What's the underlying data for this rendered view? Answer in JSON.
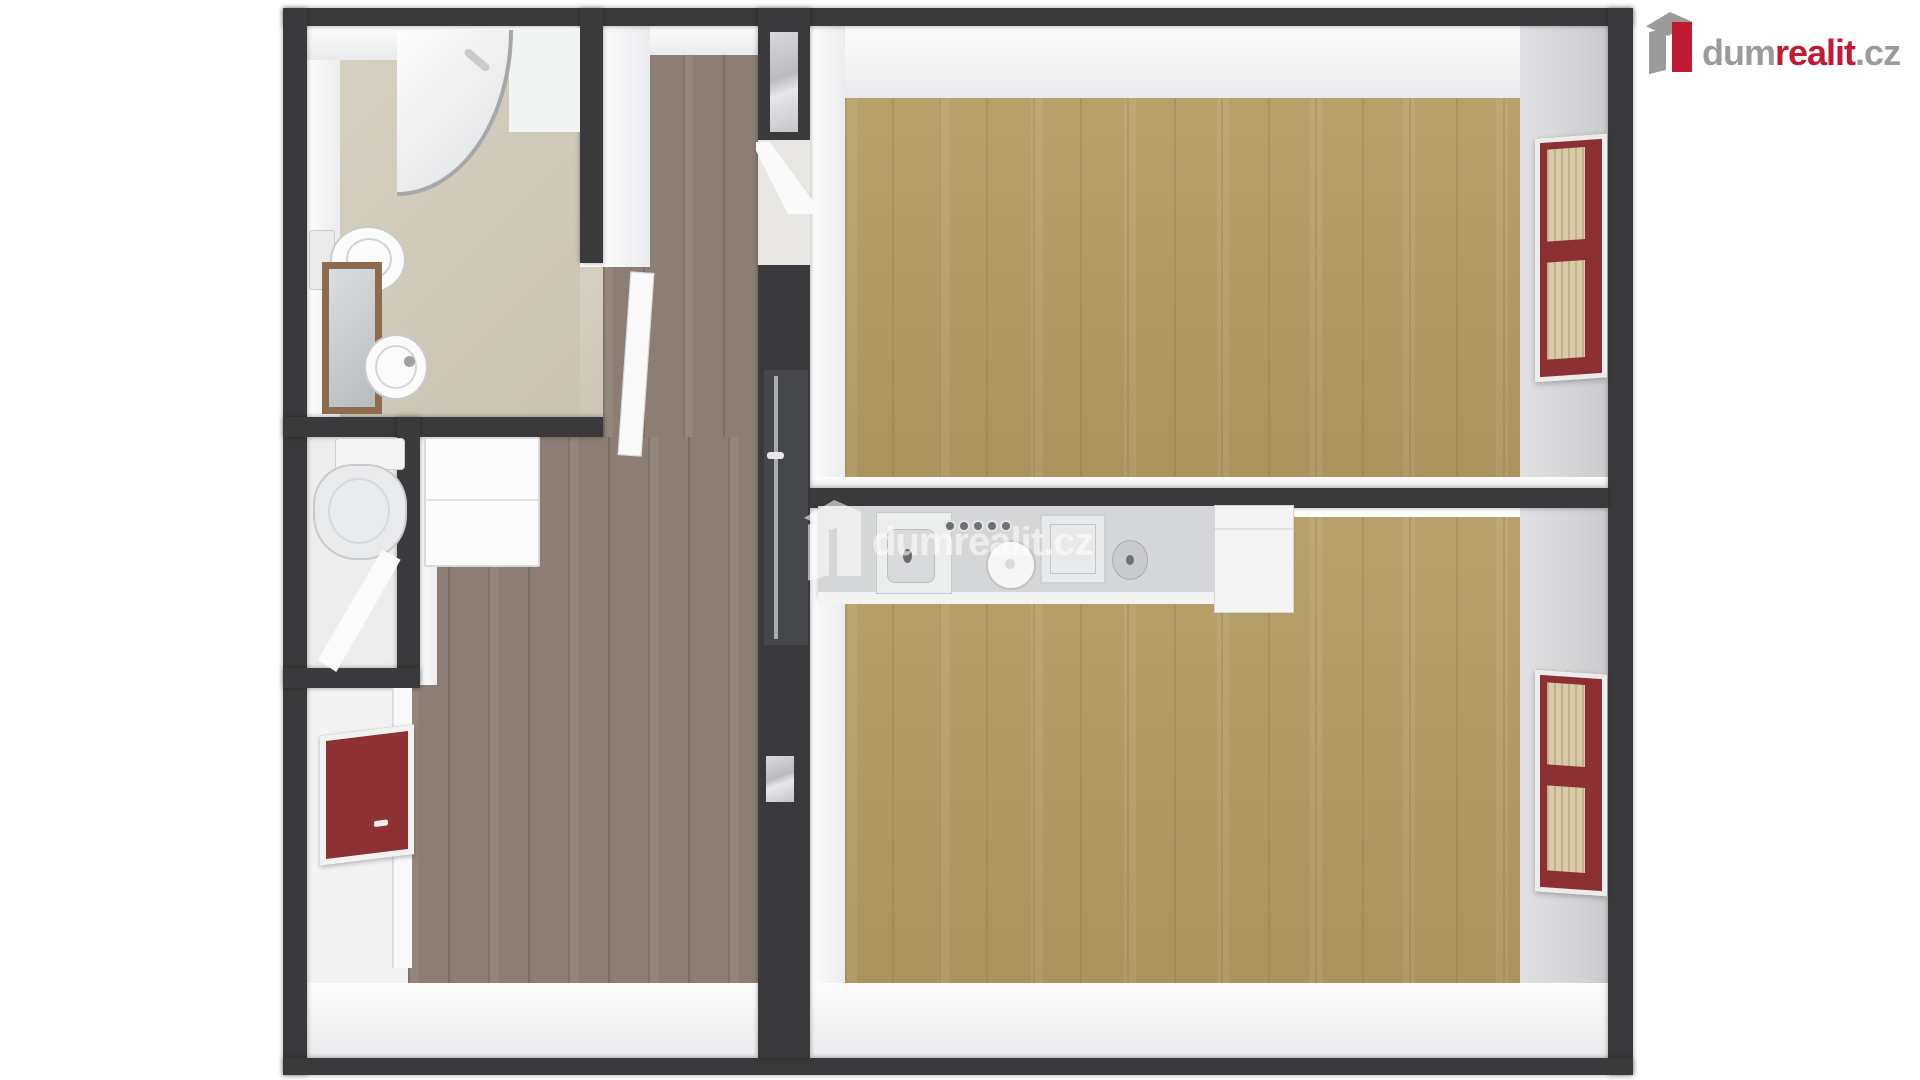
{
  "branding": {
    "logo": {
      "dum": "dum",
      "realit": "realit",
      "cz": ".cz",
      "icon": "dumrealit-building-icon"
    }
  },
  "watermark": {
    "text": "dumrealit.cz",
    "icon": "dumrealit-building-icon",
    "opacity": 0.58
  },
  "colors": {
    "wall": "#3a3a3c",
    "floorTan": "#b59b62",
    "floorTaupe": "#8c7e74",
    "floorBeige": "#cfc8b8",
    "windowRed": "#8c3034",
    "windowFill": "#d8cba6",
    "radiatorRed": "#8e3134",
    "counter": "#d5d6d8",
    "logoRed": "#c01b32",
    "logoGray": "#9b9b9b"
  },
  "floorplan": {
    "type": "3d-top-down-apartment-floor-plan",
    "rooms": [
      {
        "name": "bathroom",
        "position": "top-left",
        "floor": "beige tile",
        "fixtures": [
          "corner-shower",
          "wall-hung-toilet",
          "washbasin",
          "wood-framed-mirror"
        ]
      },
      {
        "name": "wc",
        "position": "middle-left",
        "floor": "white tile",
        "fixtures": [
          "toilet-with-cistern",
          "open-door"
        ]
      },
      {
        "name": "entry-room",
        "position": "bottom-left",
        "floor": "white",
        "fixtures": [
          "red-framed-window"
        ]
      },
      {
        "name": "hallway",
        "position": "center",
        "floor": "dark taupe wood planks",
        "fixtures": [
          "tall-white-cabinet",
          "open-bathroom-door",
          "glazed-interior-door"
        ]
      },
      {
        "name": "living-room",
        "position": "top-right",
        "floor": "light oak wood planks",
        "fixtures": [
          "red-framed-window-right-wall"
        ]
      },
      {
        "name": "kitchen-bedroom",
        "position": "bottom-right",
        "floor": "light oak wood planks",
        "fixtures": [
          "kitchen-counter",
          "sink",
          "stove-with-knobs",
          "pot",
          "dishwasher",
          "fridge",
          "red-framed-window-right-wall"
        ]
      }
    ]
  }
}
